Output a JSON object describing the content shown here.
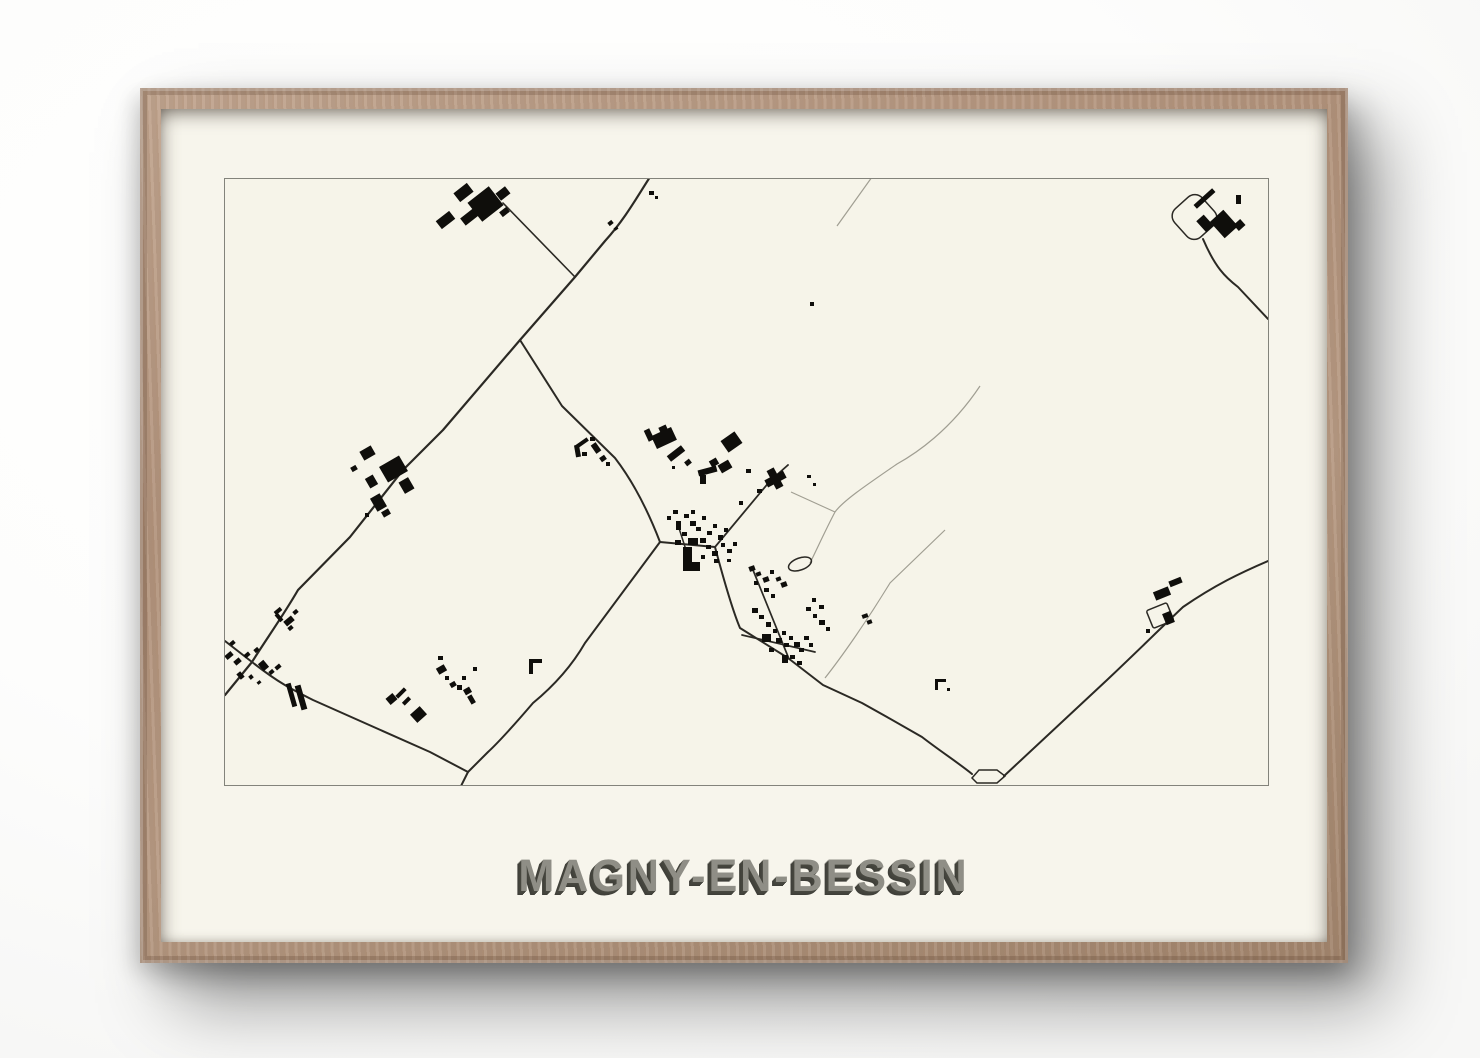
{
  "poster": {
    "title": "MAGNY-EN-BESSIN"
  },
  "palette": {
    "wall": "#ffffff",
    "frame_wood": "#b2937c",
    "mat": "#f7f5ec",
    "paper": "#f6f4e9",
    "map_border": "#83837b",
    "road": "#2b2924",
    "track": "#a09e92",
    "building": "#0f0e0b",
    "title_fill": "#8f8e86",
    "title_shadow": "#3f3f39"
  },
  "map": {
    "viewbox": "0 0 1043 606",
    "roads": [
      {
        "d": "M425,-2 C412,18 400,40 380,62 L350,98 L295,161 L218,251 L178,291 L125,358 L73,411 C58,437 40,462 27,483 L0,516",
        "w": 2.2
      },
      {
        "d": "M350,98 L278,24",
        "w": 1.6
      },
      {
        "d": "M295,161 L337,227 L390,279 C410,305 425,337 435,363",
        "w": 2
      },
      {
        "d": "M0,462 L27,483 C55,505 70,512 88,521 L205,573 L243,593 L236,607",
        "w": 2
      },
      {
        "d": "M435,363 L360,464 C345,490 325,510 308,524 C290,545 275,562 263,573 L243,593",
        "w": 2
      },
      {
        "d": "M435,363 L490,368 C498,398 507,430 515,449 L563,479 L598,506 L637,524 L662,538 L697,558 C715,572 735,585 747,595",
        "w": 2
      },
      {
        "d": "M490,368 L545,302 L563,286",
        "w": 1.8
      },
      {
        "d": "M779,597 L882,501 C920,465 940,445 958,428 C990,406 1015,394 1043,382",
        "w": 2
      },
      {
        "d": "M978,60 C990,88 1000,98 1013,108 L1043,140",
        "w": 2
      },
      {
        "d": "M528,391 L564,480",
        "w": 1.7
      },
      {
        "d": "M517,456 L590,473",
        "w": 1.7
      },
      {
        "d": "M452,343 L462,374",
        "w": 1.5
      }
    ],
    "tracks": [
      {
        "d": "M647,-2 L612,47",
        "w": 1.2
      },
      {
        "d": "M755,207 C725,252 690,275 672,285 C640,307 618,322 610,333 C600,352 592,370 585,384",
        "w": 1.2
      },
      {
        "d": "M566,313 L610,333",
        "w": 1.1
      },
      {
        "d": "M720,351 L665,404 C640,445 615,480 600,499",
        "w": 1.2
      }
    ],
    "outlines": [
      {
        "shape": "rect",
        "x": 951,
        "y": 19,
        "w": 37,
        "h": 38,
        "rx": 10,
        "rot": -42
      },
      {
        "shape": "rect",
        "x": 924,
        "y": 427,
        "w": 22,
        "h": 19,
        "rx": 2,
        "rot": -22
      },
      {
        "shape": "ellipse",
        "cx": 575,
        "cy": 385,
        "rx": 12,
        "ry": 6,
        "rot": -20
      },
      {
        "shape": "path",
        "d": "M747,599 L754,591 L772,591 L780,597 L772,604 L752,604 Z"
      }
    ],
    "buildings": [
      [
        230,
        8,
        17,
        11,
        -38
      ],
      [
        247,
        13,
        27,
        24,
        -38
      ],
      [
        272,
        10,
        12,
        9,
        -38
      ],
      [
        236,
        33,
        18,
        9,
        -38
      ],
      [
        212,
        36,
        17,
        10,
        -38
      ],
      [
        275,
        30,
        9,
        6,
        -38
      ],
      [
        383,
        42,
        5,
        4,
        -38
      ],
      [
        389,
        48,
        4,
        3,
        -38
      ],
      [
        424,
        12,
        5,
        4,
        0
      ],
      [
        430,
        17,
        3,
        3,
        0
      ],
      [
        585,
        123,
        4,
        4,
        0
      ],
      [
        967,
        17,
        25,
        5,
        -42
      ],
      [
        990,
        34,
        18,
        22,
        -42
      ],
      [
        1010,
        42,
        9,
        8,
        -42
      ],
      [
        1011,
        16,
        5,
        9,
        0
      ],
      [
        975,
        37,
        10,
        15,
        -42
      ],
      [
        350,
        262,
        14,
        4,
        -35
      ],
      [
        350,
        266,
        5,
        12,
        -10
      ],
      [
        357,
        273,
        5,
        4,
        0
      ],
      [
        365,
        258,
        5,
        4,
        0
      ],
      [
        368,
        264,
        6,
        10,
        -35
      ],
      [
        375,
        277,
        6,
        5,
        -35
      ],
      [
        381,
        283,
        4,
        4,
        0
      ],
      [
        136,
        269,
        13,
        10,
        -30
      ],
      [
        157,
        281,
        23,
        18,
        -30
      ],
      [
        176,
        300,
        11,
        13,
        -30
      ],
      [
        142,
        297,
        9,
        11,
        -30
      ],
      [
        126,
        287,
        6,
        5,
        -30
      ],
      [
        148,
        316,
        11,
        15,
        -30
      ],
      [
        157,
        331,
        8,
        6,
        -30
      ],
      [
        140,
        334,
        4,
        4,
        0
      ],
      [
        49,
        430,
        8,
        4,
        -40
      ],
      [
        52,
        434,
        4,
        9,
        -40
      ],
      [
        59,
        439,
        10,
        6,
        -40
      ],
      [
        63,
        447,
        5,
        4,
        -40
      ],
      [
        68,
        431,
        5,
        4,
        -40
      ],
      [
        0,
        474,
        8,
        5,
        -40
      ],
      [
        9,
        480,
        7,
        5,
        -40
      ],
      [
        19,
        474,
        6,
        4,
        -40
      ],
      [
        29,
        469,
        5,
        4,
        -40
      ],
      [
        35,
        482,
        7,
        9,
        -40
      ],
      [
        44,
        491,
        5,
        4,
        -40
      ],
      [
        50,
        486,
        6,
        4,
        -40
      ],
      [
        13,
        493,
        5,
        7,
        -40
      ],
      [
        24,
        496,
        4,
        4,
        -40
      ],
      [
        32,
        502,
        4,
        3,
        -40
      ],
      [
        5,
        462,
        5,
        4,
        -40
      ],
      [
        64,
        504,
        5,
        24,
        -16
      ],
      [
        73,
        506,
        6,
        25,
        -16
      ],
      [
        162,
        516,
        9,
        8,
        -40
      ],
      [
        170,
        512,
        12,
        4,
        -45
      ],
      [
        177,
        520,
        9,
        4,
        -45
      ],
      [
        187,
        530,
        13,
        11,
        -42
      ],
      [
        212,
        487,
        9,
        7,
        -30
      ],
      [
        220,
        497,
        4,
        4,
        0
      ],
      [
        225,
        503,
        6,
        5,
        -30
      ],
      [
        232,
        506,
        5,
        5,
        0
      ],
      [
        237,
        497,
        4,
        4,
        0
      ],
      [
        239,
        509,
        7,
        6,
        -30
      ],
      [
        244,
        516,
        5,
        9,
        -30
      ],
      [
        248,
        488,
        4,
        4,
        0
      ],
      [
        213,
        477,
        5,
        4,
        0
      ],
      [
        304,
        480,
        13,
        4,
        0
      ],
      [
        304,
        484,
        4,
        11,
        0
      ],
      [
        421,
        250,
        6,
        12,
        -25
      ],
      [
        434,
        247,
        8,
        5,
        -25
      ],
      [
        428,
        252,
        22,
        14,
        -25
      ],
      [
        442,
        271,
        18,
        7,
        -38
      ],
      [
        460,
        281,
        6,
        5,
        -38
      ],
      [
        447,
        287,
        3,
        3,
        0
      ],
      [
        473,
        289,
        19,
        6,
        -15
      ],
      [
        475,
        296,
        6,
        9,
        0
      ],
      [
        485,
        280,
        8,
        7,
        -30
      ],
      [
        494,
        283,
        12,
        9,
        -30
      ],
      [
        498,
        256,
        17,
        14,
        -35
      ],
      [
        521,
        290,
        5,
        4,
        0
      ],
      [
        532,
        310,
        5,
        4,
        0
      ],
      [
        514,
        322,
        4,
        4,
        0
      ],
      [
        582,
        296,
        4,
        3,
        0
      ],
      [
        588,
        304,
        3,
        3,
        0
      ],
      [
        540,
        296,
        21,
        8,
        -28
      ],
      [
        546,
        289,
        8,
        21,
        -28
      ],
      [
        448,
        331,
        5,
        4,
        0
      ],
      [
        442,
        337,
        4,
        4,
        0
      ],
      [
        451,
        342,
        5,
        9,
        0
      ],
      [
        459,
        335,
        5,
        4,
        0
      ],
      [
        465,
        342,
        6,
        5,
        0
      ],
      [
        471,
        348,
        5,
        4,
        0
      ],
      [
        477,
        337,
        4,
        4,
        0
      ],
      [
        457,
        353,
        5,
        4,
        0
      ],
      [
        463,
        359,
        10,
        7,
        0
      ],
      [
        450,
        361,
        6,
        5,
        0
      ],
      [
        458,
        368,
        9,
        15,
        0
      ],
      [
        458,
        383,
        17,
        9,
        0
      ],
      [
        475,
        359,
        6,
        5,
        0
      ],
      [
        482,
        352,
        5,
        4,
        0
      ],
      [
        488,
        345,
        4,
        4,
        0
      ],
      [
        481,
        366,
        5,
        4,
        0
      ],
      [
        487,
        372,
        6,
        5,
        0
      ],
      [
        476,
        376,
        4,
        4,
        0
      ],
      [
        493,
        356,
        5,
        5,
        0
      ],
      [
        499,
        349,
        4,
        4,
        0
      ],
      [
        496,
        364,
        4,
        4,
        0
      ],
      [
        502,
        370,
        5,
        4,
        0
      ],
      [
        508,
        363,
        4,
        4,
        0
      ],
      [
        489,
        380,
        5,
        4,
        0
      ],
      [
        502,
        380,
        4,
        3,
        0
      ],
      [
        466,
        331,
        4,
        4,
        0
      ],
      [
        524,
        387,
        6,
        5,
        -20
      ],
      [
        531,
        393,
        5,
        4,
        -20
      ],
      [
        538,
        398,
        6,
        5,
        -20
      ],
      [
        545,
        391,
        4,
        4,
        0
      ],
      [
        551,
        398,
        5,
        4,
        -20
      ],
      [
        556,
        403,
        6,
        5,
        -20
      ],
      [
        539,
        409,
        5,
        4,
        0
      ],
      [
        546,
        415,
        4,
        4,
        0
      ],
      [
        529,
        402,
        4,
        4,
        0
      ],
      [
        527,
        429,
        6,
        5,
        0
      ],
      [
        534,
        436,
        5,
        4,
        0
      ],
      [
        541,
        443,
        5,
        5,
        0
      ],
      [
        548,
        450,
        4,
        4,
        0
      ],
      [
        537,
        455,
        9,
        8,
        0
      ],
      [
        551,
        459,
        6,
        5,
        0
      ],
      [
        557,
        452,
        4,
        4,
        0
      ],
      [
        559,
        464,
        5,
        4,
        0
      ],
      [
        564,
        457,
        4,
        4,
        0
      ],
      [
        569,
        463,
        6,
        5,
        0
      ],
      [
        574,
        469,
        5,
        4,
        0
      ],
      [
        579,
        457,
        5,
        4,
        0
      ],
      [
        584,
        464,
        4,
        4,
        0
      ],
      [
        565,
        476,
        5,
        4,
        0
      ],
      [
        572,
        482,
        5,
        4,
        0
      ],
      [
        557,
        476,
        6,
        8,
        0
      ],
      [
        544,
        469,
        5,
        4,
        0
      ],
      [
        581,
        428,
        5,
        4,
        0
      ],
      [
        588,
        435,
        4,
        4,
        0
      ],
      [
        594,
        441,
        6,
        5,
        0
      ],
      [
        601,
        448,
        4,
        4,
        0
      ],
      [
        587,
        419,
        4,
        4,
        0
      ],
      [
        594,
        426,
        5,
        4,
        0
      ],
      [
        637,
        435,
        6,
        4,
        -20
      ],
      [
        642,
        441,
        5,
        4,
        -20
      ],
      [
        710,
        500,
        11,
        3,
        0
      ],
      [
        710,
        503,
        3,
        8,
        0
      ],
      [
        722,
        509,
        3,
        3,
        0
      ],
      [
        944,
        400,
        13,
        6,
        -22
      ],
      [
        929,
        410,
        16,
        9,
        -22
      ],
      [
        939,
        433,
        9,
        12,
        -22
      ],
      [
        921,
        450,
        4,
        4,
        0
      ]
    ]
  }
}
